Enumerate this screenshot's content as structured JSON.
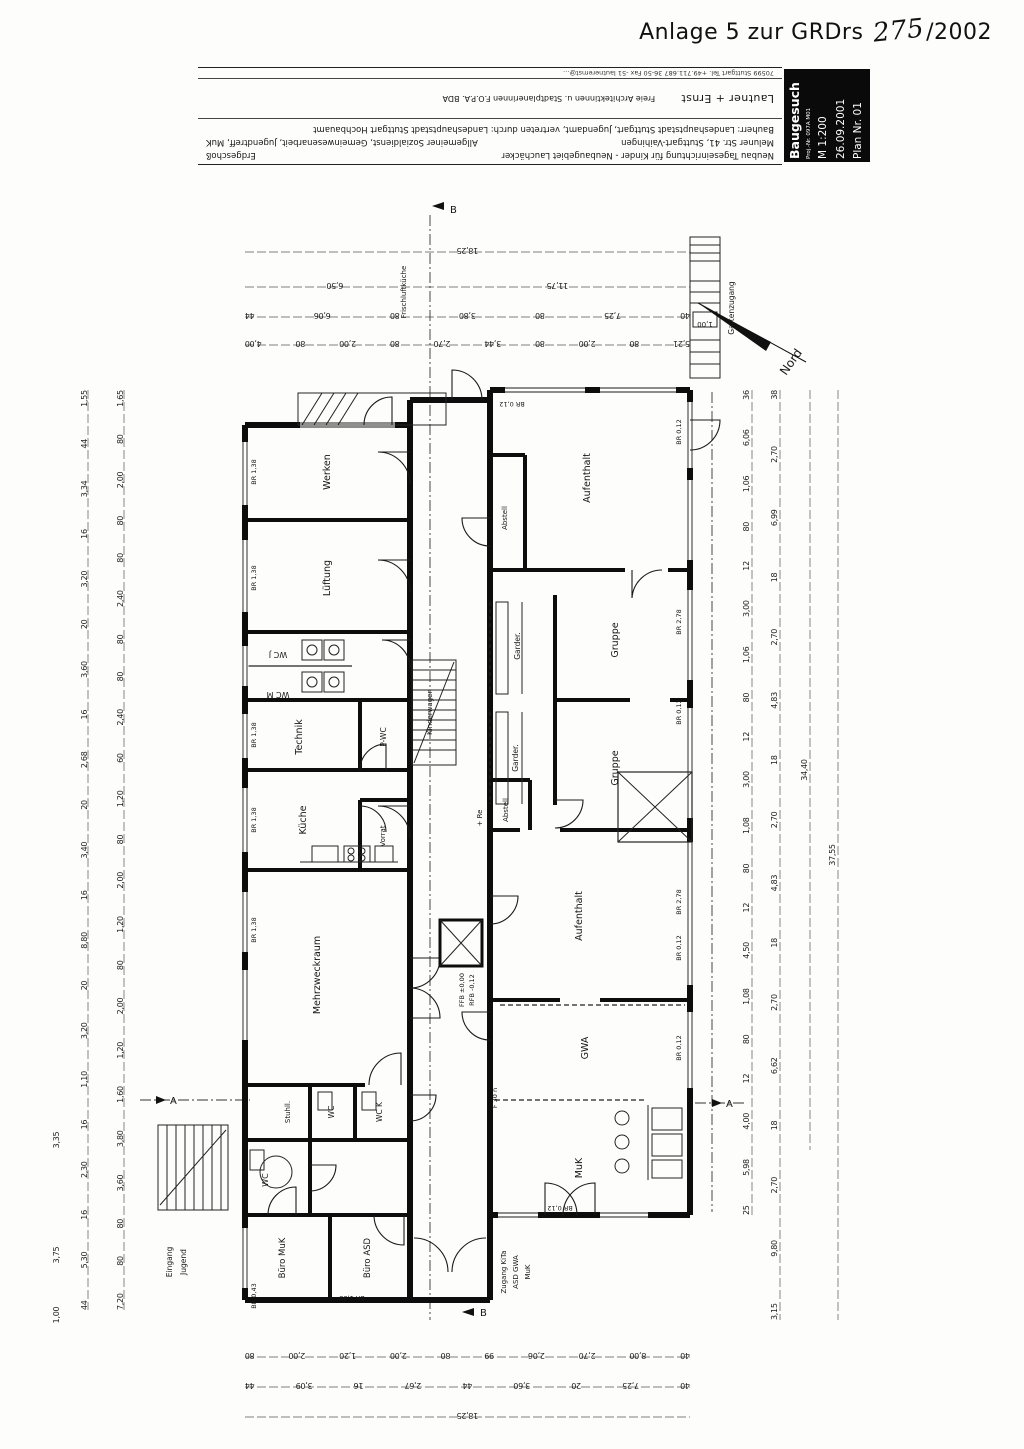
{
  "header": {
    "title": "Anlage 5  zur GRDrs",
    "number": "275",
    "suffix": "/2002"
  },
  "title_block": {
    "stamp": {
      "type": "Baugesuch",
      "proj": "Proj.-Nr. 097A M01",
      "scale": "M   1:200",
      "date": "26.09.2001",
      "plan": "Plan Nr. 01"
    },
    "project": "Neubau Tageseinrichtung für Kinder - Neubaugebiet Lauchäcker",
    "floor": "Erdgeschoß",
    "address": "Meluner Str. 41, Stuttgart-Vaihingen",
    "uses": "Allgemeiner Sozialdienst, Gemeinwesenarbeit, Jugendtreff, MuK",
    "client": "Bauherr: Landeshauptstadt Stuttgart, Jugendamt, vertreten durch: Landeshauptstadt Stuttgart Hochbauamt",
    "architect": "Lautner + Ernst",
    "architect_line": "Freie Architektinnen u. Stadtplanerinnen F.O.P.A. BDA",
    "architect_contact": "70599 Stuttgart   Tel. +49.711.687 36-50   Fax -51   lautnerernst@…"
  },
  "rooms": {
    "werken": "Werken",
    "lueftung": "Lüftung",
    "wcj": "WC J",
    "wcm": "WC M",
    "technik": "Technik",
    "pwc": "P-WC",
    "kueche": "Küche",
    "vorrat": "Vorrat",
    "mehrzweck": "Mehrzweckraum",
    "stuhl": "Stuhll.",
    "wc": "WC",
    "wck": "WC K",
    "wcb": "WC",
    "buero_muk": "Büro MuK",
    "buero_asd": "Büro ASD",
    "aufenthalt1": "Aufenthalt",
    "abstell1": "Abstell",
    "garder1": "Garder.",
    "gruppe1": "Gruppe",
    "gruppe2": "Gruppe",
    "garder2": "Garder.",
    "abstell2": "Abstell",
    "aufenthalt2": "Aufenthalt",
    "gwa": "GWA",
    "muk": "MuK",
    "kinderwagen": "Kinderwagen"
  },
  "labels": {
    "eingang1": "Eingang",
    "eingang2": "Jugend",
    "zugang1": "Zugang KiTa",
    "zugang2": "ASD  GWA",
    "zugang3": "MuK",
    "gartenzugang": "Gartenzugang",
    "frischluft": "Frischluftküche",
    "nord": "Nord",
    "ffb": "FFB ±0,00",
    "rfb": "RFB -0,12",
    "f30": "F 30 n",
    "re": "+ Re",
    "ramp_dim": "1,00",
    "section_a": "A",
    "section_b": "B"
  },
  "notes": [
    "BR 1,38",
    "BR 1,38",
    "BR 1,38",
    "BR 1,38",
    "BR 1,38",
    "BR 0,12",
    "BR 2,78",
    "BR 0,12",
    "BR 2,78",
    "BR 0,12",
    "BR 0,12",
    "BR 0,12",
    "BR 1,38",
    "BR 0,43",
    "BR 0,12"
  ],
  "dims": {
    "top_total": "18,25",
    "top_650": "6,50",
    "top_1175": "11,75",
    "top3": [
      "44",
      "6,06",
      "80",
      "3,80",
      "80",
      "7,25",
      "40"
    ],
    "top4": [
      "4,00",
      "80",
      "2,00",
      "80",
      "2,70",
      "3,44",
      "80",
      "2,00",
      "80",
      "5,21"
    ],
    "bottom1": [
      "80",
      "2,00",
      "1,20",
      "2,00",
      "80",
      "99",
      "2,06",
      "2,70",
      "8,00",
      "40"
    ],
    "bottom2": [
      "44",
      "3,09",
      "16",
      "2,67",
      "44",
      "3,60",
      "20",
      "7,25",
      "40"
    ],
    "bottom_total": "18,25",
    "left_outer": [
      "1,55",
      "44",
      "3,34",
      "16",
      "3,20",
      "20",
      "3,60",
      "16",
      "2,68",
      "20",
      "3,40",
      "16",
      "8,80",
      "20",
      "3,20",
      "1,10",
      "16",
      "2,30",
      "16",
      "5,30",
      "44"
    ],
    "left_inner": [
      "1,65",
      "80",
      "2,00",
      "80",
      "80",
      "2,40",
      "80",
      "80",
      "2,40",
      "60",
      "1,20",
      "80",
      "2,00",
      "1,20",
      "80",
      "2,00",
      "1,20",
      "1,60",
      "3,80",
      "3,60",
      "80",
      "80",
      "7,20"
    ],
    "left_335": "3,35",
    "left_375": "3,75",
    "left_100": "1,00",
    "right_outer": [
      "36",
      "6,06",
      "1,06",
      "80",
      "12",
      "3,00",
      "1,06",
      "80",
      "12",
      "3,00",
      "1,08",
      "80",
      "12",
      "4,50",
      "1,08",
      "80",
      "12",
      "4,00",
      "5,98",
      "25"
    ],
    "right_mid": [
      "38",
      "2,70",
      "6,99",
      "18",
      "2,70",
      "4,83",
      "18",
      "2,70",
      "4,83",
      "18",
      "2,70",
      "6,62",
      "18",
      "2,70",
      "9,80",
      "3,15"
    ],
    "right_total_a": "34,40",
    "right_total_b": "37,55"
  }
}
